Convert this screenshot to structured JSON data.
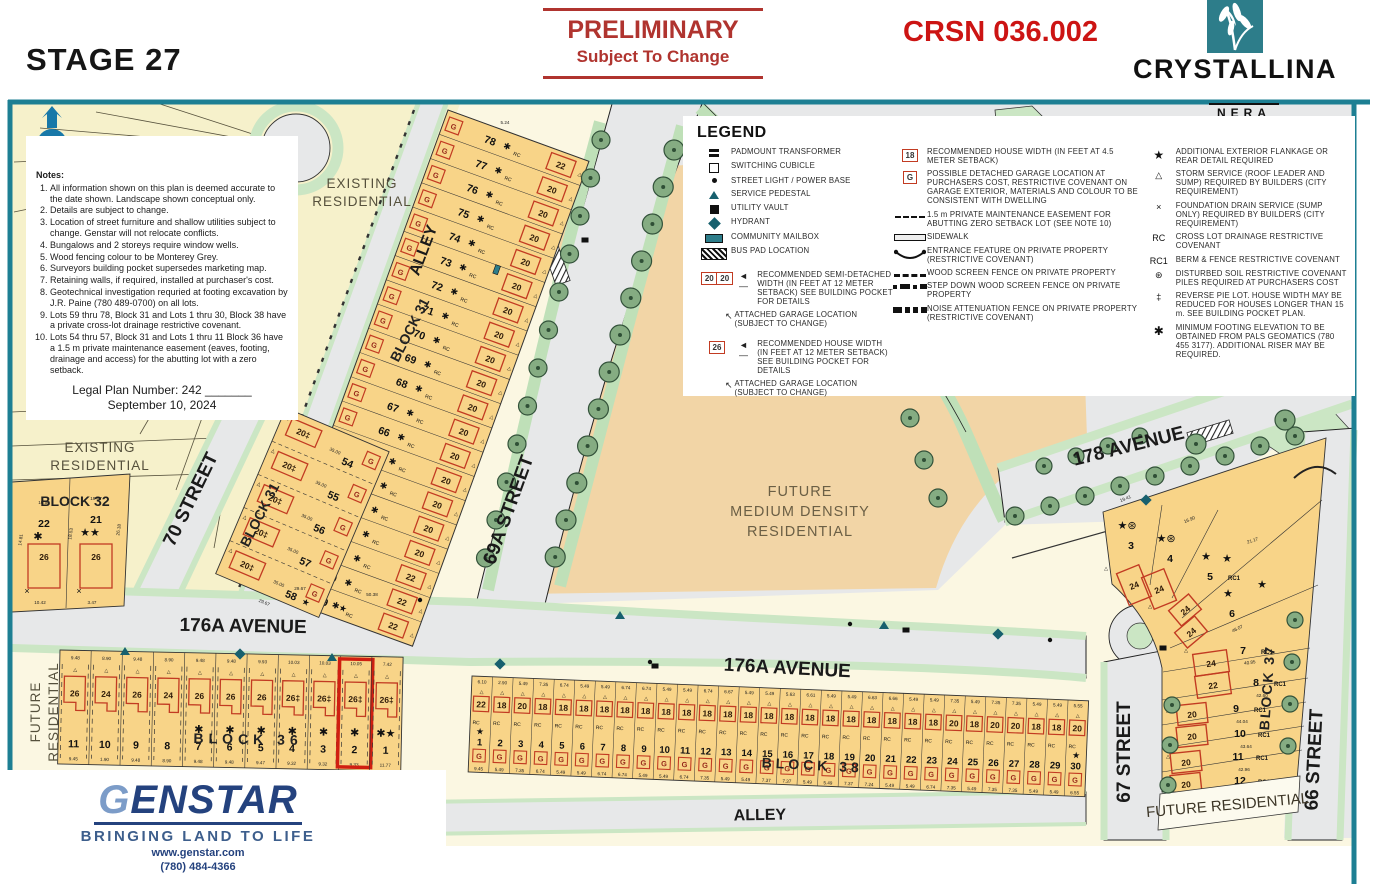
{
  "header": {
    "stage": "STAGE 27",
    "preliminary_title": "PRELIMINARY",
    "preliminary_sub": "Subject To Change",
    "plan_code": "CRSN 036.002",
    "brand_name": "CRYSTALLINA",
    "brand_sub": "NERA"
  },
  "notes": {
    "heading": "Notes:",
    "items": [
      "All information shown on this plan is deemed accurate to the date shown.  Landscape shown conceptual only.",
      "Details are subject to change.",
      "Location of street furniture and shallow utilities subject to change.  Genstar will not relocate conflicts.",
      "Bungalows and 2 storeys require window wells.",
      "Wood fencing colour to be Monterey Grey.",
      "Surveyors building pocket supersedes marketing map.",
      "Retaining walls, if required, installed at purchaser's cost.",
      "Geotechnical investigation requried at footing excavation by J.R. Paine (780 489-0700) on all lots.",
      "Lots 59 thru 78, Block 31 and Lots 1 thru 30, Block 38 have a private cross-lot drainage restrictive covenant.",
      "Lots 54 thru 57, Block 31 and Lots 1 thru 11 Block 36 have a 1.5 m private maintenance easement (eaves, footing, drainage and access) for the abutting lot with a zero setback."
    ],
    "legal_line1": "Legal Plan Number: 242 _______",
    "legal_line2": "September 10, 2024"
  },
  "legend": {
    "title": "LEGEND",
    "col1": [
      {
        "icon": "padmount-transformer-icon",
        "label": "PADMOUNT TRANSFORMER"
      },
      {
        "icon": "switching-cubicle-icon",
        "label": "SWITCHING CUBICLE"
      },
      {
        "icon": "street-light-icon",
        "label": "STREET LIGHT / POWER BASE"
      },
      {
        "icon": "service-pedestal-icon",
        "label": "SERVICE PEDESTAL"
      },
      {
        "icon": "utility-vault-icon",
        "label": "UTILITY VAULT"
      },
      {
        "icon": "hydrant-icon",
        "label": "HYDRANT"
      },
      {
        "icon": "community-mailbox-icon",
        "label": "COMMUNITY MAILBOX"
      },
      {
        "icon": "bus-pad-icon",
        "label": "BUS PAD LOCATION"
      }
    ],
    "semi_box": "20|20",
    "semi_label": "RECOMMENDED SEMI-DETACHED WIDTH (IN FEET AT 12 METER SETBACK) SEE BUILDING POCKET FOR DETAILS",
    "semi_sub": "ATTACHED GARAGE LOCATION (SUBJECT TO CHANGE)",
    "single_box": "26",
    "single_label": "RECOMMENDED HOUSE WIDTH (IN FEET AT 12 METER SETBACK) SEE BUILDING POCKET FOR DETAILS",
    "single_sub": "ATTACHED GARAGE LOCATION (SUBJECT TO CHANGE)",
    "col2": [
      {
        "icon": "box-18-icon",
        "box": "18",
        "label": "RECOMMENDED HOUSE WIDTH (IN FEET AT 4.5 METER SETBACK)"
      },
      {
        "icon": "box-g-icon",
        "box": "G",
        "label": "POSSIBLE DETACHED GARAGE LOCATION AT PURCHASERS COST, RESTRICTIVE COVENANT ON GARAGE EXTERIOR, MATERIALS AND COLOUR TO BE CONSISTENT WITH DWELLING"
      },
      {
        "icon": "easement-dash-icon",
        "label": "1.5 m PRIVATE MAINTENANCE EASEMENT FOR ABUTTING ZERO SETBACK LOT (SEE NOTE 10)"
      },
      {
        "icon": "sidewalk-icon",
        "label": "SIDEWALK"
      },
      {
        "icon": "entrance-feature-icon",
        "label": "ENTRANCE FEATURE ON PRIVATE PROPERTY (RESTRICTIVE COVENANT)"
      },
      {
        "icon": "wood-fence-icon",
        "label": "WOOD SCREEN FENCE ON PRIVATE PROPERTY"
      },
      {
        "icon": "stepdown-fence-icon",
        "label": "STEP DOWN WOOD SCREEN FENCE ON PRIVATE PROPERTY"
      },
      {
        "icon": "noise-fence-icon",
        "label": "NOISE ATTENUATION FENCE ON PRIVATE PROPERTY (RESTRICTIVE COVENANT)"
      }
    ],
    "col3": [
      {
        "icon": "star-icon",
        "sym": "★",
        "label": "ADDITIONAL EXTERIOR FLANKAGE OR REAR DETAIL REQUIRED"
      },
      {
        "icon": "storm-triangle-icon",
        "sym": "△",
        "label": "STORM SERVICE (ROOF LEADER AND SUMP) REQUIRED BY BUILDERS (CITY REQUIREMENT)"
      },
      {
        "icon": "foundation-x-icon",
        "sym": "×",
        "label": "FOUNDATION DRAIN SERVICE (SUMP ONLY) REQUIRED BY BUILDERS (CITY REQUIREMENT)"
      },
      {
        "icon": "rc-icon",
        "sym": "RC",
        "label": "CROSS LOT DRAINAGE RESTRICTIVE COVENANT"
      },
      {
        "icon": "rc1-icon",
        "sym": "RC1",
        "label": "BERM & FENCE RESTRICTIVE COVENANT"
      },
      {
        "icon": "disturbed-soil-icon",
        "sym": "⊛",
        "label": "DISTURBED SOIL RESTRICTIVE COVENANT PILES REQUIRED AT PURCHASERS COST"
      },
      {
        "icon": "reverse-pie-icon",
        "sym": "‡",
        "label": "REVERSE PIE LOT.  HOUSE WIDTH MAY BE REDUCED FOR HOUSES LONGER THAN 15 m.  SEE BUILDING POCKET PLAN."
      },
      {
        "icon": "footing-asterisk-icon",
        "sym": "✱",
        "label": "MINIMUM FOOTING ELEVATION TO BE OBTAINED FROM PALS GEOMATICS (780 455 3177).  ADDITIONAL RISER MAY BE REQUIRED."
      }
    ]
  },
  "map": {
    "labels": {
      "existing_residential": [
        "EXISTING",
        "RESIDENTIAL"
      ],
      "alley": "ALLEY",
      "street_70": "70 STREET",
      "street_69a": "69A STREET",
      "street_67": "67 STREET",
      "street_66": "66 STREET",
      "avenue_176a": "176A AVENUE",
      "avenue_178": "178 AVENUE",
      "future_medium": [
        "FUTURE",
        "MEDIUM DENSITY",
        "RESIDENTIAL"
      ],
      "future_residential": "FUTURE RESIDENTIAL",
      "future_residential_words": [
        "FUTURE",
        "RESIDENTIAL"
      ],
      "block_31": "BLOCK 31",
      "block_32": "BLOCK 32",
      "block_36": "BLOCK 36",
      "block_37": "BLOCK 37",
      "block_38": "BLOCK 38"
    },
    "stray_dims": [
      [
        "5.24",
        505,
        124
      ],
      [
        "50.38",
        372,
        596
      ],
      [
        "29.67",
        300,
        590
      ]
    ],
    "block32": {
      "lots": [
        {
          "num": "22",
          "width": "26",
          "marks": "✱",
          "dim_top": "10.50",
          "dim_bottom": "10.42"
        },
        {
          "num": "21",
          "width": "26",
          "marks": "★★",
          "dim_top": "19.67",
          "dim_bottom": "3.47"
        }
      ],
      "side_dims": [
        "14.81",
        "18.53",
        "26.18"
      ]
    },
    "block31_column": {
      "dim_bottom": "29.67",
      "lots": [
        {
          "num": "54",
          "width": "20‡",
          "side": "35.00"
        },
        {
          "num": "55",
          "width": "20‡",
          "side": "35.00"
        },
        {
          "num": "56",
          "width": "20‡",
          "side": "35.00"
        },
        {
          "num": "57",
          "width": "20‡",
          "side": "35.00"
        },
        {
          "num": "58",
          "width": "20‡",
          "side": "35.00",
          "marks": "★"
        }
      ]
    },
    "block31_band": {
      "dim_top": "5.24",
      "lots": [
        {
          "num": "78",
          "width": "22",
          "marks": "✱",
          "rc": "RC"
        },
        {
          "num": "77",
          "width": "20",
          "marks": "✱",
          "rc": "RC"
        },
        {
          "num": "76",
          "width": "20",
          "marks": "✱",
          "rc": "RC"
        },
        {
          "num": "75",
          "width": "20",
          "marks": "✱",
          "rc": "RC"
        },
        {
          "num": "74",
          "width": "20",
          "marks": "✱",
          "rc": "RC"
        },
        {
          "num": "73",
          "width": "20",
          "marks": "✱",
          "rc": "RC"
        },
        {
          "num": "72",
          "width": "20",
          "marks": "✱",
          "rc": "RC"
        },
        {
          "num": "71",
          "width": "20",
          "marks": "✱",
          "rc": "RC"
        },
        {
          "num": "70",
          "width": "20",
          "marks": "✱",
          "rc": "RC"
        },
        {
          "num": "69",
          "width": "20",
          "marks": "✱",
          "rc": "RC"
        },
        {
          "num": "68",
          "width": "20",
          "marks": "✱",
          "rc": "RC"
        },
        {
          "num": "67",
          "width": "20",
          "marks": "✱",
          "rc": "RC"
        },
        {
          "num": "66",
          "width": "20",
          "marks": "✱",
          "rc": "RC"
        },
        {
          "num": "65",
          "width": "20",
          "marks": "✱",
          "rc": "RC"
        },
        {
          "num": "64",
          "width": "20",
          "marks": "✱",
          "rc": "RC"
        },
        {
          "num": "63",
          "width": "20",
          "marks": "✱",
          "rc": "RC"
        },
        {
          "num": "62",
          "width": "20",
          "marks": "✱",
          "rc": "RC"
        },
        {
          "num": "61",
          "width": "22",
          "marks": "✱",
          "rc": "RC"
        },
        {
          "num": "60",
          "width": "22",
          "marks": "✱",
          "rc": "RC"
        },
        {
          "num": "59",
          "width": "22",
          "marks": "✱★",
          "rc": "RC"
        }
      ]
    },
    "block36": {
      "lots": [
        {
          "num": "11",
          "width": "26",
          "dim_top": "9.48",
          "dim_bottom": "9.45"
        },
        {
          "num": "10",
          "width": "24",
          "dim_top": "8.90",
          "dim_bottom": "1.90"
        },
        {
          "num": "9",
          "width": "26",
          "dim_top": "9.48",
          "dim_bottom": "9.48"
        },
        {
          "num": "8",
          "width": "24",
          "dim_top": "8.90",
          "dim_bottom": "8.90"
        },
        {
          "num": "7",
          "width": "26",
          "dim_top": "9.48",
          "dim_bottom": "9.48",
          "marks": "✱"
        },
        {
          "num": "6",
          "width": "26",
          "dim_top": "9.48",
          "dim_bottom": "9.48",
          "marks": "✱"
        },
        {
          "num": "5",
          "width": "26",
          "dim_top": "9.93",
          "dim_bottom": "9.47",
          "marks": "✱"
        },
        {
          "num": "4",
          "width": "26‡",
          "dim_top": "10.03",
          "dim_bottom": "9.32",
          "marks": "✱"
        },
        {
          "num": "3",
          "width": "26‡",
          "dim_top": "10.03",
          "dim_bottom": "9.32",
          "marks": "✱"
        },
        {
          "num": "2",
          "width": "26‡",
          "dim_top": "10.05",
          "dim_bottom": "9.33",
          "marks": "✱",
          "highlight": true
        },
        {
          "num": "1",
          "width": "26‡",
          "dim_top": "7.42",
          "dim_bottom": "11.77",
          "marks": "✱★"
        }
      ]
    },
    "block38": {
      "lots": [
        {
          "num": "1",
          "width": "22",
          "dim_top": "6.10",
          "dim_bottom": "9.45",
          "star": true
        },
        {
          "num": "2",
          "width": "18",
          "dim_top": "2.90",
          "dim_bottom": "5.49"
        },
        {
          "num": "3",
          "width": "20",
          "dim_top": "5.49",
          "dim_bottom": "7.35"
        },
        {
          "num": "4",
          "width": "18",
          "dim_top": "7.35",
          "dim_bottom": "6.74"
        },
        {
          "num": "5",
          "width": "18",
          "dim_top": "6.74",
          "dim_bottom": "5.49"
        },
        {
          "num": "6",
          "width": "18",
          "dim_top": "5.49",
          "dim_bottom": "5.49"
        },
        {
          "num": "7",
          "width": "18",
          "dim_top": "5.49",
          "dim_bottom": "6.74"
        },
        {
          "num": "8",
          "width": "18",
          "dim_top": "6.74",
          "dim_bottom": "6.74"
        },
        {
          "num": "9",
          "width": "18",
          "dim_top": "6.74",
          "dim_bottom": "5.49"
        },
        {
          "num": "10",
          "width": "18",
          "dim_top": "5.49",
          "dim_bottom": "5.49"
        },
        {
          "num": "11",
          "width": "18",
          "dim_top": "5.49",
          "dim_bottom": "6.74"
        },
        {
          "num": "12",
          "width": "18",
          "dim_top": "6.74",
          "dim_bottom": "7.35"
        },
        {
          "num": "13",
          "width": "18",
          "dim_top": "6.67",
          "dim_bottom": "5.49"
        },
        {
          "num": "14",
          "width": "18",
          "dim_top": "5.49",
          "dim_bottom": "5.49"
        },
        {
          "num": "15",
          "width": "18",
          "dim_top": "5.49",
          "dim_bottom": "7.37"
        },
        {
          "num": "16",
          "width": "18",
          "dim_top": "5.63",
          "dim_bottom": "7.37"
        },
        {
          "num": "17",
          "width": "18",
          "dim_top": "6.61",
          "dim_bottom": "5.49"
        },
        {
          "num": "18",
          "width": "18",
          "dim_top": "5.49",
          "dim_bottom": "5.49"
        },
        {
          "num": "19",
          "width": "18",
          "dim_top": "5.49",
          "dim_bottom": "7.37"
        },
        {
          "num": "20",
          "width": "18",
          "dim_top": "6.63",
          "dim_bottom": "7.24"
        },
        {
          "num": "21",
          "width": "18",
          "dim_top": "6.66",
          "dim_bottom": "5.49"
        },
        {
          "num": "22",
          "width": "18",
          "dim_top": "5.49",
          "dim_bottom": "5.49"
        },
        {
          "num": "23",
          "width": "18",
          "dim_top": "5.49",
          "dim_bottom": "6.74"
        },
        {
          "num": "24",
          "width": "20",
          "dim_top": "7.35",
          "dim_bottom": "7.35"
        },
        {
          "num": "25",
          "width": "18",
          "dim_top": "5.49",
          "dim_bottom": "5.49"
        },
        {
          "num": "26",
          "width": "20",
          "dim_top": "7.35",
          "dim_bottom": "7.35"
        },
        {
          "num": "27",
          "width": "20",
          "dim_top": "7.35",
          "dim_bottom": "7.35"
        },
        {
          "num": "28",
          "width": "18",
          "dim_top": "5.49",
          "dim_bottom": "5.49"
        },
        {
          "num": "29",
          "width": "18",
          "dim_top": "5.49",
          "dim_bottom": "5.49"
        },
        {
          "num": "30",
          "width": "20",
          "dim_top": "5.55",
          "dim_bottom": "6.55",
          "star": true
        }
      ]
    },
    "block37": {
      "houses": [
        "24",
        "24",
        "24",
        "24",
        "24",
        "22",
        "20",
        "20",
        "20",
        "20"
      ],
      "lots": [
        {
          "num": "3",
          "marks": "★⊛"
        },
        {
          "num": "4",
          "marks": "★⊛"
        },
        {
          "num": "5",
          "marks": "★",
          "rc": "RC1"
        },
        {
          "num": "6",
          "marks": "★"
        },
        {
          "num": "7",
          "rc": "RC1"
        },
        {
          "num": "8",
          "rc": "RC1",
          "dim": "42.60"
        },
        {
          "num": "9",
          "rc": "RC1",
          "dim": "44.04"
        },
        {
          "num": "10",
          "rc": "RC1",
          "dim": "43.64"
        },
        {
          "num": "11",
          "rc": "RC1",
          "dim": "42.96"
        },
        {
          "num": "12",
          "rc": "RC1",
          "dim": "42.36"
        }
      ],
      "dims": [
        [
          "19.41",
          1126,
          500,
          -22
        ],
        [
          "16.90",
          1190,
          521,
          -22
        ],
        [
          "21.17",
          1253,
          542,
          -18
        ],
        [
          "46.07",
          1238,
          630,
          -26
        ],
        [
          "40.85",
          1250,
          664,
          -8
        ]
      ]
    }
  },
  "genstar": {
    "name": "GENSTAR",
    "tagline": "BRINGING LAND TO LIFE",
    "web": "www.genstar.com",
    "phone": "(780) 484-4366"
  }
}
